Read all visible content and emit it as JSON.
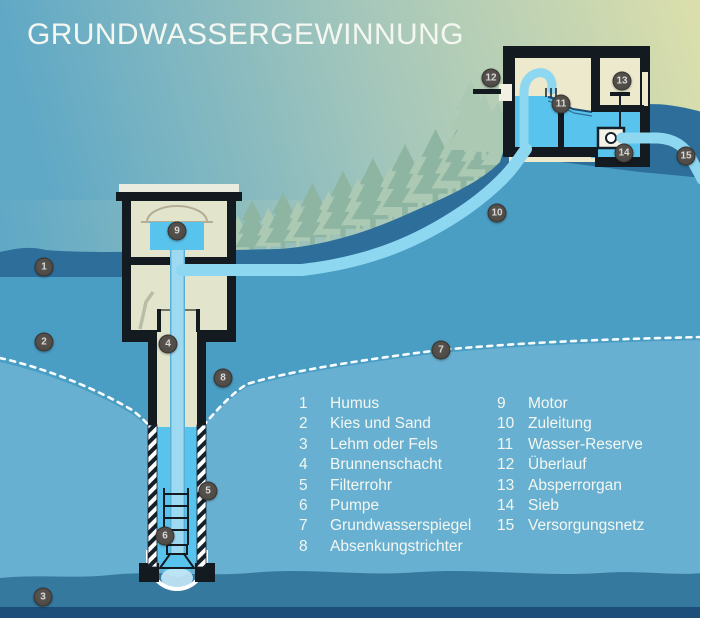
{
  "title": "GRUNDWASSERGEWINNUNG",
  "legend": {
    "left": [
      {
        "num": "1",
        "label": "Humus"
      },
      {
        "num": "2",
        "label": "Kies und Sand"
      },
      {
        "num": "3",
        "label": "Lehm oder Fels"
      },
      {
        "num": "4",
        "label": "Brunnenschacht"
      },
      {
        "num": "5",
        "label": "Filterrohr"
      },
      {
        "num": "6",
        "label": "Pumpe"
      },
      {
        "num": "7",
        "label": "Grundwasserspiegel"
      },
      {
        "num": "8",
        "label": "Absenkungstrichter"
      }
    ],
    "right": [
      {
        "num": "9",
        "label": "Motor"
      },
      {
        "num": "10",
        "label": "Zuleitung"
      },
      {
        "num": "11",
        "label": "Wasser-Reserve"
      },
      {
        "num": "12",
        "label": "Überlauf"
      },
      {
        "num": "13",
        "label": "Absperrorgan"
      },
      {
        "num": "14",
        "label": "Sieb"
      },
      {
        "num": "15",
        "label": "Versorgungsnetz"
      }
    ]
  },
  "badges": [
    {
      "n": "1",
      "x": 44,
      "y": 267
    },
    {
      "n": "2",
      "x": 44,
      "y": 342
    },
    {
      "n": "3",
      "x": 43,
      "y": 597
    },
    {
      "n": "4",
      "x": 168,
      "y": 344
    },
    {
      "n": "5",
      "x": 208,
      "y": 491
    },
    {
      "n": "6",
      "x": 165,
      "y": 536
    },
    {
      "n": "7",
      "x": 441,
      "y": 350
    },
    {
      "n": "8",
      "x": 223,
      "y": 378
    },
    {
      "n": "9",
      "x": 177,
      "y": 231
    },
    {
      "n": "10",
      "x": 497,
      "y": 213
    },
    {
      "n": "11",
      "x": 561,
      "y": 104
    },
    {
      "n": "12",
      "x": 491,
      "y": 78
    },
    {
      "n": "13",
      "x": 622,
      "y": 81
    },
    {
      "n": "14",
      "x": 624,
      "y": 153
    },
    {
      "n": "15",
      "x": 686,
      "y": 156
    }
  ],
  "colors": {
    "skyLeft": "#5fa8c6",
    "skyMid": "#a3c6bb",
    "skyRight": "#dcdfab",
    "treeLight": "#abc9b3",
    "treeDark": "#8db5a2",
    "humus": "#2d6f9a",
    "medium": "#4a9dc3",
    "light": "#68b0d1",
    "layer3": "#35799f",
    "navy": "#1d4e79",
    "pipe": "#8ed7f1",
    "water": "#58c3ec",
    "creamHouse": "#e2e5cc",
    "creamRes": "#ece9cd",
    "black": "#131a20",
    "white": "#ffffff",
    "dome": "#b3ae95",
    "badgeBg": "#4e4a46",
    "badgeText": "#dad8d4",
    "textWhite": "#f4f7f1",
    "darkLine": "#1d4d74"
  }
}
